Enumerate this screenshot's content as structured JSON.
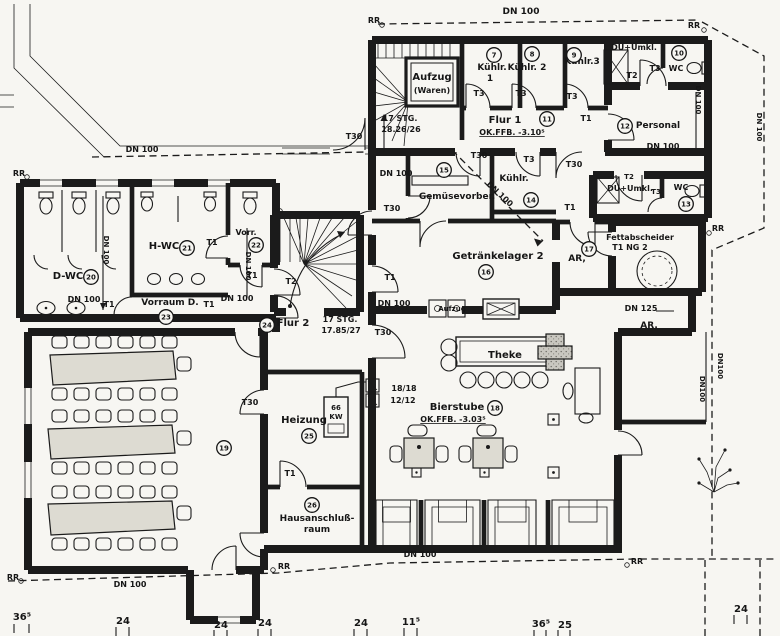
{
  "drawing": {
    "type": "architectural-floor-plan",
    "language": "de",
    "paper_color": "#f7f6f2",
    "ink_color": "#1b1b1b",
    "wall_fill_color": "#c9c7c0",
    "rooms": [
      {
        "no": "7",
        "name": "Kühlr. 1"
      },
      {
        "no": "8",
        "name": "Kühlr. 2"
      },
      {
        "no": "9",
        "name": "Kühlr.3"
      },
      {
        "no": "10",
        "name": "DU+Umkl."
      },
      {
        "no": "11",
        "name": "Flur 1"
      },
      {
        "no": "12",
        "name": "Personal"
      },
      {
        "no": "13",
        "name": "DU+Umkl. WC"
      },
      {
        "no": "14",
        "name": "Kühlr."
      },
      {
        "no": "15",
        "name": "Gemüsevorber."
      },
      {
        "no": "16",
        "name": "Getränkelager 2"
      },
      {
        "no": "17",
        "name": "AR,"
      },
      {
        "no": "18",
        "name": "Bierstube"
      },
      {
        "no": "19",
        "name": ""
      },
      {
        "no": "20",
        "name": "D-WC"
      },
      {
        "no": "21",
        "name": "H-WC"
      },
      {
        "no": "22",
        "name": "Vorr."
      },
      {
        "no": "23",
        "name": "Vorraum D."
      },
      {
        "no": "24",
        "name": "Flur 2"
      },
      {
        "no": "25",
        "name": "Heizung"
      },
      {
        "no": "26",
        "name": "Hausanschlußraum"
      }
    ],
    "levels": {
      "flur1": "OK.FFB. -3.10⁵",
      "bierstube": "OK.FFB. -3.03⁵"
    },
    "stairs": [
      {
        "label": "17 STG.",
        "detail": "18.26/26"
      },
      {
        "label": "17 STG.",
        "detail": "17.85/27"
      }
    ],
    "dimensions": [
      "36⁵",
      "24",
      "24",
      "24",
      "24",
      "11⁵",
      "36⁵",
      "25",
      "24"
    ],
    "labels": [
      {
        "t": "DN 100",
        "x": 521,
        "y": 14,
        "fs": 9
      },
      {
        "t": "RR",
        "x": 374,
        "y": 23,
        "fs": 8
      },
      {
        "t": "RR",
        "x": 694,
        "y": 28,
        "fs": 8
      },
      {
        "t": "Aufzug",
        "x": 432,
        "y": 80,
        "fs": 10
      },
      {
        "t": "(Waren)",
        "x": 432,
        "y": 93,
        "fs": 8
      },
      {
        "t": "Kühlr.",
        "x": 492,
        "y": 70,
        "fs": 9
      },
      {
        "t": "1",
        "x": 490,
        "y": 81,
        "fs": 9
      },
      {
        "t": "Kühlr. 2",
        "x": 527,
        "y": 70,
        "fs": 9
      },
      {
        "t": "Kühlr.3",
        "x": 582,
        "y": 64,
        "fs": 9
      },
      {
        "t": "T3",
        "x": 479,
        "y": 96,
        "fs": 8
      },
      {
        "t": "T3",
        "x": 521,
        "y": 96,
        "fs": 8
      },
      {
        "t": "T3",
        "x": 572,
        "y": 99,
        "fs": 8
      },
      {
        "t": "DU+Umkl.",
        "x": 634,
        "y": 50,
        "fs": 8
      },
      {
        "t": "T2",
        "x": 632,
        "y": 78,
        "fs": 8
      },
      {
        "t": "T3",
        "x": 655,
        "y": 71,
        "fs": 8
      },
      {
        "t": "WC",
        "x": 676,
        "y": 71,
        "fs": 8
      },
      {
        "t": "17 STG.",
        "x": 400,
        "y": 121,
        "fs": 8
      },
      {
        "t": "18.26/26",
        "x": 401,
        "y": 132,
        "fs": 8
      },
      {
        "t": "Flur 1",
        "x": 505,
        "y": 123,
        "fs": 10
      },
      {
        "t": "OK.FFB. -3.10⁵",
        "x": 512,
        "y": 135,
        "fs": 8,
        "ul": 1
      },
      {
        "t": "T1",
        "x": 586,
        "y": 121,
        "fs": 8
      },
      {
        "t": "Personal",
        "x": 658,
        "y": 128,
        "fs": 9
      },
      {
        "t": "DN 100",
        "x": 663,
        "y": 149,
        "fs": 8
      },
      {
        "t": "DN 100",
        "x": 696,
        "y": 100,
        "fs": 7,
        "rot": 90
      },
      {
        "t": "DN 100",
        "x": 757,
        "y": 127,
        "fs": 7,
        "rot": 90
      },
      {
        "t": "DN 100",
        "x": 142,
        "y": 152,
        "fs": 8
      },
      {
        "t": "T30",
        "x": 354,
        "y": 139,
        "fs": 8
      },
      {
        "t": "DN 100",
        "x": 396,
        "y": 176,
        "fs": 8
      },
      {
        "t": "T30",
        "x": 479,
        "y": 158,
        "fs": 8
      },
      {
        "t": "T3",
        "x": 529,
        "y": 162,
        "fs": 8
      },
      {
        "t": "T30",
        "x": 574,
        "y": 167,
        "fs": 8
      },
      {
        "t": "T30",
        "x": 392,
        "y": 211,
        "fs": 8
      },
      {
        "t": "Gemüsevorber.",
        "x": 457,
        "y": 199,
        "fs": 9
      },
      {
        "t": "Kühlr.",
        "x": 514,
        "y": 181,
        "fs": 9
      },
      {
        "t": "DN 100",
        "x": 498,
        "y": 196,
        "fs": 8,
        "rot": 43
      },
      {
        "t": "DU+Umkl.",
        "x": 630,
        "y": 191,
        "fs": 8
      },
      {
        "t": "T2",
        "x": 629,
        "y": 179,
        "fs": 7
      },
      {
        "t": "T3",
        "x": 656,
        "y": 194,
        "fs": 7
      },
      {
        "t": "WC",
        "x": 681,
        "y": 190,
        "fs": 8
      },
      {
        "t": "Fettabscheider",
        "x": 640,
        "y": 240,
        "fs": 8
      },
      {
        "t": "T1 NG 2",
        "x": 630,
        "y": 250,
        "fs": 8
      },
      {
        "t": "RR",
        "x": 718,
        "y": 231,
        "fs": 8
      },
      {
        "t": "Getränkelager 2",
        "x": 498,
        "y": 259,
        "fs": 10
      },
      {
        "t": "AR,",
        "x": 577,
        "y": 261,
        "fs": 9
      },
      {
        "t": "T1",
        "x": 570,
        "y": 210,
        "fs": 8
      },
      {
        "t": "DN 125",
        "x": 641,
        "y": 311,
        "fs": 8
      },
      {
        "t": "AR.",
        "x": 649,
        "y": 328,
        "fs": 9
      },
      {
        "t": "DN100",
        "x": 718,
        "y": 366,
        "fs": 7,
        "rot": 90
      },
      {
        "t": "DN100",
        "x": 700,
        "y": 389,
        "fs": 7,
        "rot": 90
      },
      {
        "t": "RR",
        "x": 19,
        "y": 176,
        "fs": 8
      },
      {
        "t": "D-WC",
        "x": 68,
        "y": 279,
        "fs": 10
      },
      {
        "t": "DN 100",
        "x": 104,
        "y": 250,
        "fs": 7,
        "rot": 90
      },
      {
        "t": "DN 100",
        "x": 84,
        "y": 302,
        "fs": 8
      },
      {
        "t": "T1",
        "x": 109,
        "y": 307,
        "fs": 8
      },
      {
        "t": "H-WC",
        "x": 164,
        "y": 249,
        "fs": 10
      },
      {
        "t": "T1",
        "x": 212,
        "y": 245,
        "fs": 8
      },
      {
        "t": "Vorr.",
        "x": 246,
        "y": 235,
        "fs": 8
      },
      {
        "t": "DN 100",
        "x": 246,
        "y": 266,
        "fs": 7,
        "rot": 90
      },
      {
        "t": "T1",
        "x": 252,
        "y": 278,
        "fs": 8
      },
      {
        "t": "Vorraum D.",
        "x": 170,
        "y": 305,
        "fs": 9
      },
      {
        "t": "T1",
        "x": 209,
        "y": 307,
        "fs": 8
      },
      {
        "t": "DN 100",
        "x": 237,
        "y": 301,
        "fs": 8
      },
      {
        "t": "Flur 2",
        "x": 293,
        "y": 326,
        "fs": 10
      },
      {
        "t": "17 STG.",
        "x": 340,
        "y": 322,
        "fs": 8
      },
      {
        "t": "17.85/27",
        "x": 341,
        "y": 333,
        "fs": 8
      },
      {
        "t": "T30",
        "x": 383,
        "y": 335,
        "fs": 8
      },
      {
        "t": "T2",
        "x": 291,
        "y": 284,
        "fs": 8
      },
      {
        "t": "T1",
        "x": 390,
        "y": 280,
        "fs": 8
      },
      {
        "t": "DN 100",
        "x": 394,
        "y": 306,
        "fs": 8
      },
      {
        "t": "T30",
        "x": 250,
        "y": 405,
        "fs": 8
      },
      {
        "t": "Heizung",
        "x": 304,
        "y": 423,
        "fs": 10
      },
      {
        "t": "66",
        "x": 336,
        "y": 410,
        "fs": 7
      },
      {
        "t": "KW",
        "x": 336,
        "y": 419,
        "fs": 7
      },
      {
        "t": "T1",
        "x": 290,
        "y": 476,
        "fs": 8
      },
      {
        "t": "Hausanschluß-",
        "x": 317,
        "y": 521,
        "fs": 9
      },
      {
        "t": "raum",
        "x": 317,
        "y": 532,
        "fs": 9
      },
      {
        "t": "18/18",
        "x": 404,
        "y": 391,
        "fs": 8
      },
      {
        "t": "12/12",
        "x": 403,
        "y": 403,
        "fs": 8
      },
      {
        "t": "Theke",
        "x": 505,
        "y": 358,
        "fs": 10
      },
      {
        "t": "Bierstube",
        "x": 457,
        "y": 410,
        "fs": 10
      },
      {
        "t": "OK.FFB. -3.03⁵",
        "x": 453,
        "y": 422,
        "fs": 8,
        "ul": 1
      },
      {
        "t": "Aufzug",
        "x": 452,
        "y": 311,
        "fs": 7
      },
      {
        "t": "DN 100",
        "x": 130,
        "y": 587,
        "fs": 8
      },
      {
        "t": "DN 100",
        "x": 420,
        "y": 557,
        "fs": 8
      },
      {
        "t": "RR",
        "x": 13,
        "y": 580,
        "fs": 8
      },
      {
        "t": "RR",
        "x": 284,
        "y": 569,
        "fs": 8
      },
      {
        "t": "RR",
        "x": 637,
        "y": 564,
        "fs": 8
      },
      {
        "t": "36⁵",
        "x": 22,
        "y": 620,
        "fs": 10
      },
      {
        "t": "24",
        "x": 123,
        "y": 624,
        "fs": 10
      },
      {
        "t": "24",
        "x": 221,
        "y": 628,
        "fs": 10
      },
      {
        "t": "24",
        "x": 265,
        "y": 626,
        "fs": 10
      },
      {
        "t": "24",
        "x": 361,
        "y": 626,
        "fs": 10
      },
      {
        "t": "11⁵",
        "x": 411,
        "y": 625,
        "fs": 10
      },
      {
        "t": "36⁵",
        "x": 541,
        "y": 627,
        "fs": 10
      },
      {
        "t": "25",
        "x": 565,
        "y": 628,
        "fs": 10
      },
      {
        "t": "24",
        "x": 741,
        "y": 612,
        "fs": 10
      }
    ],
    "room_bubbles": [
      {
        "n": "7",
        "x": 494,
        "y": 55
      },
      {
        "n": "8",
        "x": 532,
        "y": 54
      },
      {
        "n": "9",
        "x": 574,
        "y": 55
      },
      {
        "n": "10",
        "x": 679,
        "y": 53
      },
      {
        "n": "11",
        "x": 547,
        "y": 119
      },
      {
        "n": "12",
        "x": 625,
        "y": 126
      },
      {
        "n": "13",
        "x": 686,
        "y": 204
      },
      {
        "n": "14",
        "x": 531,
        "y": 200
      },
      {
        "n": "15",
        "x": 444,
        "y": 170
      },
      {
        "n": "16",
        "x": 486,
        "y": 272
      },
      {
        "n": "17",
        "x": 589,
        "y": 249
      },
      {
        "n": "18",
        "x": 495,
        "y": 408
      },
      {
        "n": "19",
        "x": 224,
        "y": 448
      },
      {
        "n": "20",
        "x": 91,
        "y": 277
      },
      {
        "n": "21",
        "x": 187,
        "y": 248
      },
      {
        "n": "22",
        "x": 256,
        "y": 245
      },
      {
        "n": "23",
        "x": 166,
        "y": 317
      },
      {
        "n": "24",
        "x": 267,
        "y": 325
      },
      {
        "n": "25",
        "x": 309,
        "y": 436
      },
      {
        "n": "26",
        "x": 312,
        "y": 505
      }
    ]
  }
}
